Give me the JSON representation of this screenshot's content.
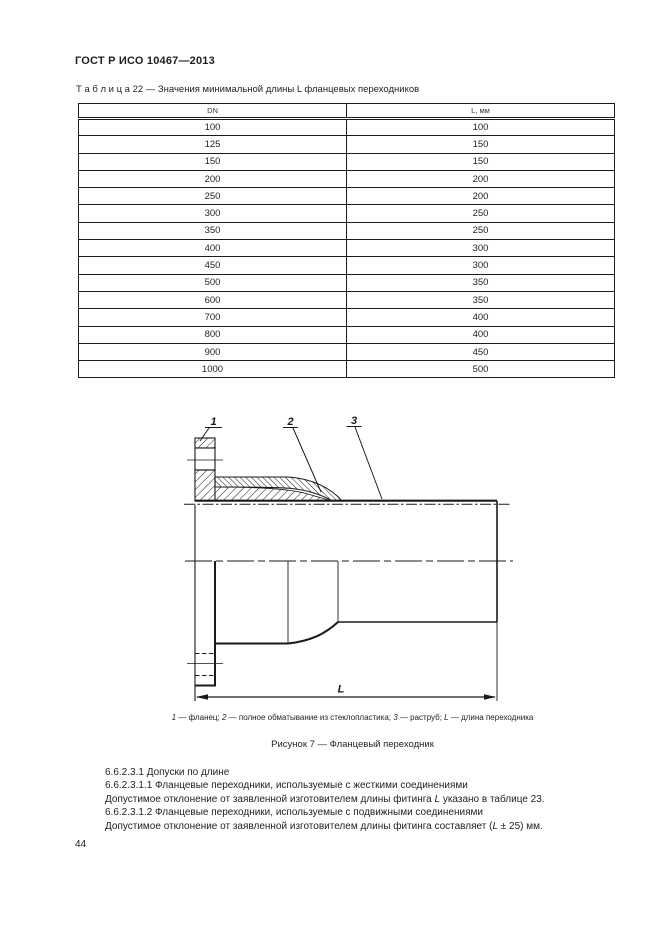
{
  "page": {
    "standard_header": "ГОСТ Р ИСО 10467—2013",
    "number": "44"
  },
  "table": {
    "caption": "Т а б л и ц а  22 — Значения минимальной длины L фланцевых переходников",
    "columns": [
      "DN",
      "L, мм"
    ],
    "rows": [
      [
        "100",
        "100"
      ],
      [
        "125",
        "150"
      ],
      [
        "150",
        "150"
      ],
      [
        "200",
        "200"
      ],
      [
        "250",
        "200"
      ],
      [
        "300",
        "250"
      ],
      [
        "350",
        "250"
      ],
      [
        "400",
        "300"
      ],
      [
        "450",
        "300"
      ],
      [
        "500",
        "350"
      ],
      [
        "600",
        "350"
      ],
      [
        "700",
        "400"
      ],
      [
        "800",
        "400"
      ],
      [
        "900",
        "450"
      ],
      [
        "1000",
        "500"
      ]
    ]
  },
  "figure": {
    "callouts": [
      "1",
      "2",
      "3"
    ],
    "dim_label": "L",
    "caption_segments": [
      {
        "t": "1",
        "i": true
      },
      {
        "t": " — фланец; "
      },
      {
        "t": "2",
        "i": true
      },
      {
        "t": " — полное обматывание из стеклопластика; "
      },
      {
        "t": "3",
        "i": true
      },
      {
        "t": " — раструб; "
      },
      {
        "t": "L",
        "i": true
      },
      {
        "t": " — длина переходника"
      }
    ],
    "title": "Рисунок 7 — Фланцевый переходник"
  },
  "paragraphs": [
    {
      "segments": [
        {
          "t": "6.6.2.3.1  Допуски по длине"
        }
      ]
    },
    {
      "segments": [
        {
          "t": "6.6.2.3.1.1  Фланцевые переходники, используемые с жесткими соединениями"
        }
      ]
    },
    {
      "segments": [
        {
          "t": "Допустимое отклонение от заявленной изготовителем длины фитинга "
        },
        {
          "t": "L",
          "i": true
        },
        {
          "t": " указано в таблице 23."
        }
      ]
    },
    {
      "segments": [
        {
          "t": "6.6.2.3.1.2  Фланцевые переходники, используемые с подвижными соединениями"
        }
      ]
    },
    {
      "segments": [
        {
          "t": "Допустимое отклонение от заявленной изготовителем длины фитинга составляет ("
        },
        {
          "t": "L",
          "i": true
        },
        {
          "t": " ± 25) мм."
        }
      ]
    }
  ]
}
